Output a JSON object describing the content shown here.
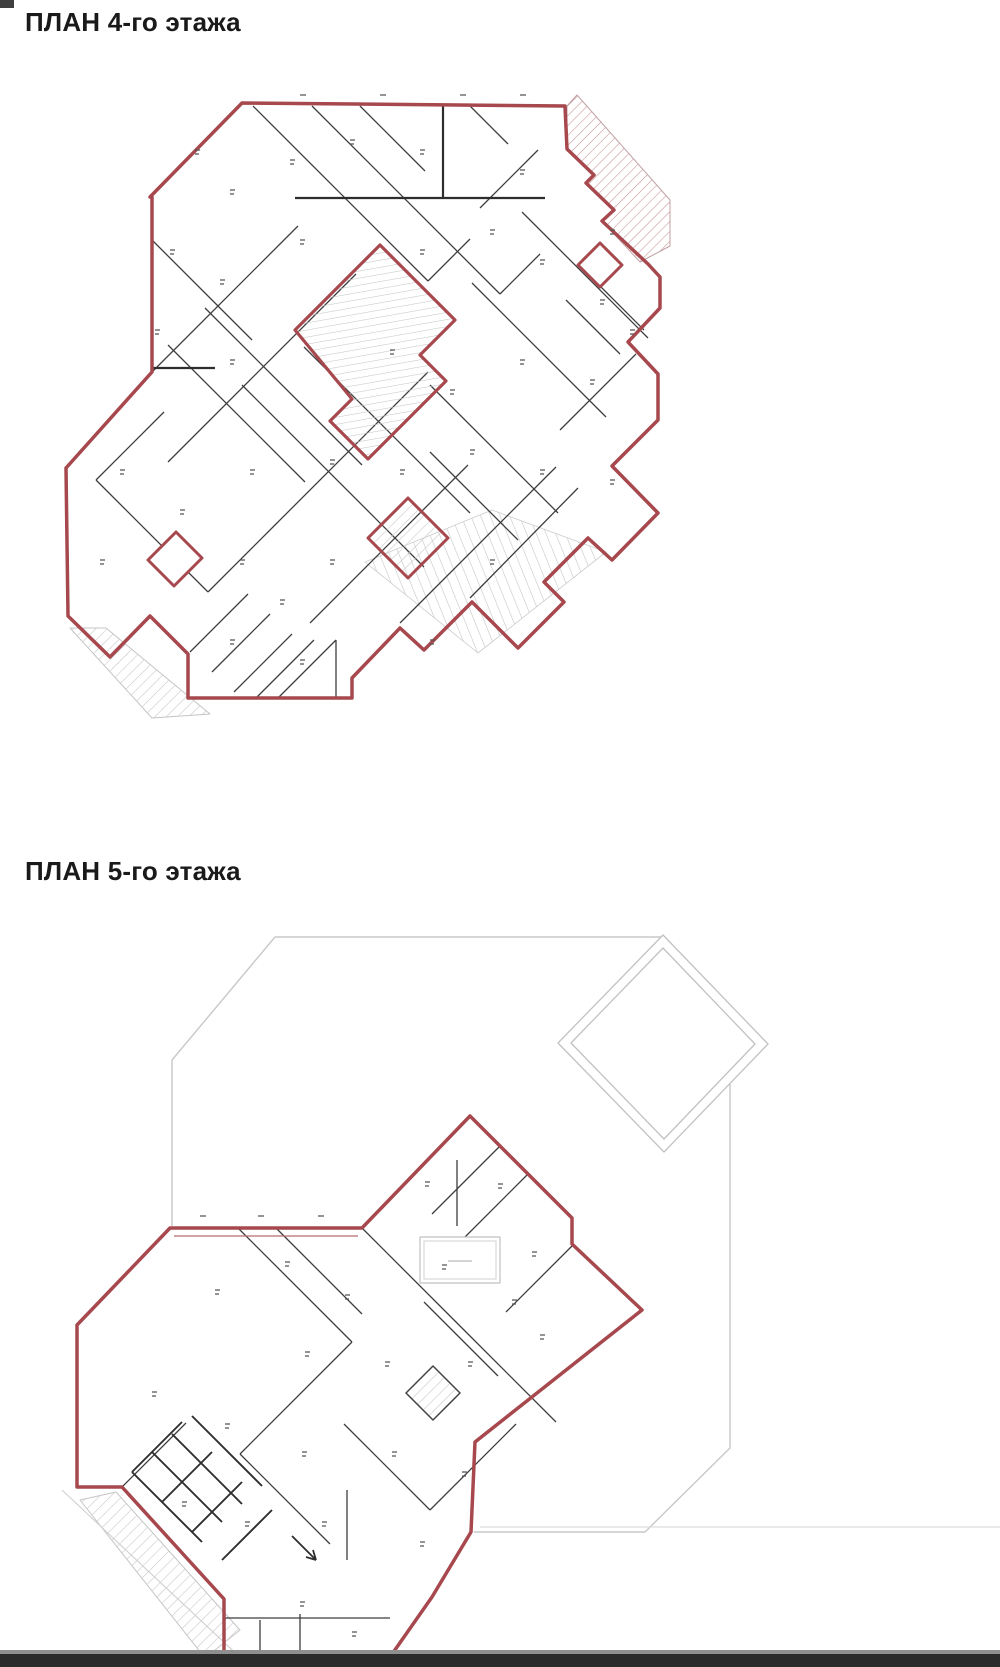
{
  "page": {
    "background_color": "#ffffff",
    "footer_bar_color": "#2b2b2b",
    "corner_notch_color": "#3f3f3f"
  },
  "plans": [
    {
      "id": "plan-4",
      "title": "ПЛАН 4-го этажа"
    },
    {
      "id": "plan-5",
      "title": "ПЛАН 5-го этажа"
    }
  ],
  "drawing_colors": {
    "outline_red": "#a6484d",
    "outline_red_light": "#b86a6e",
    "interior_wall": "#3d3d3d",
    "roof_gray": "#c8c8c8",
    "hatch_gray": "#c9c9c9",
    "hatch_red": "#c49094",
    "label_mark": "#555555"
  }
}
